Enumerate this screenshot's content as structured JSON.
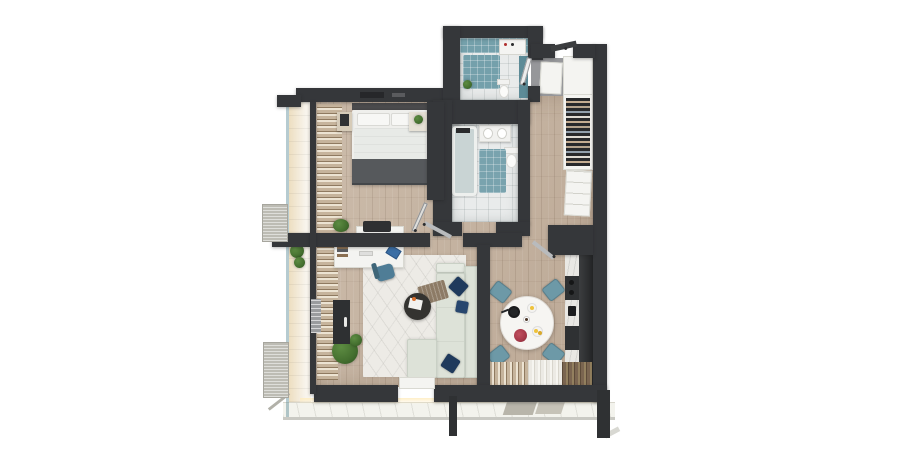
{
  "scene": {
    "title": "Apartment 3D floor plan — top-down render",
    "view": "top-down 3D architectural visualization",
    "background": "#ffffff"
  },
  "colors": {
    "bg": "#ffffff",
    "wall": "#35373a",
    "wood": "#c7b5a2",
    "tile": "#e9ebeb",
    "teal": "#74a0ab",
    "tealDark": "#5d8b97",
    "terrace": "#f3f3ed",
    "curtain": "#c6b49c",
    "curtainLight": "#ece3d2",
    "curtainDark": "#8f7a60",
    "sofa": "#dde2d8",
    "navy": "#1f3a5c",
    "chairTeal": "#6d99a7",
    "bedWhite": "#efefec",
    "blanket": "#56595c",
    "counter": "#e9e8e4",
    "cabinet": "#2f3133",
    "plant": "#446f2f",
    "accentRed": "#a83a4a",
    "accentYellow": "#eec23c"
  },
  "rooms": [
    {
      "id": "bedroom",
      "name": "Bedroom"
    },
    {
      "id": "bathroom",
      "name": "Bathroom"
    },
    {
      "id": "wc",
      "name": "WC / Laundry"
    },
    {
      "id": "hallway",
      "name": "Hallway / Entry"
    },
    {
      "id": "living-room",
      "name": "Living room"
    },
    {
      "id": "kitchen-dining",
      "name": "Kitchen / Dining"
    },
    {
      "id": "balcony",
      "name": "Balcony"
    },
    {
      "id": "terrace",
      "name": "Terrace"
    }
  ],
  "furniture": {
    "bedroom": [
      "double bed with gray throw",
      "two pillows",
      "nightstand with picture",
      "nightstand with plant",
      "curtain wardrobe wall"
    ],
    "bathroom": [
      "bathtub",
      "vanity with sink",
      "toilet",
      "teal bath mat"
    ],
    "wc": [
      "washing machine",
      "toilet",
      "teal shower mat",
      "plant",
      "teal cabinet"
    ],
    "hallway": [
      "entrance door",
      "open wardrobe with clothes",
      "white drawer unit",
      "entry closets"
    ],
    "living_room": [
      "desk with monitor, laptop and books",
      "office chair",
      "corner sofa",
      "navy cushions",
      "brown throw",
      "round coffee table",
      "area rug",
      "potted plant",
      "tv cabinet",
      "sideboard with briefcase",
      "radiator"
    ],
    "kitchen_dining": [
      "counter with cooktop and sink",
      "tall dark cabinets",
      "round dining table",
      "four teal chairs",
      "pan, plates, flowers, lemons",
      "window curtains"
    ],
    "balcony": [
      "glass railing",
      "privacy screens",
      "plants"
    ],
    "terrace": [
      "tiled deck",
      "glass railing",
      "support posts",
      "door mats"
    ]
  }
}
